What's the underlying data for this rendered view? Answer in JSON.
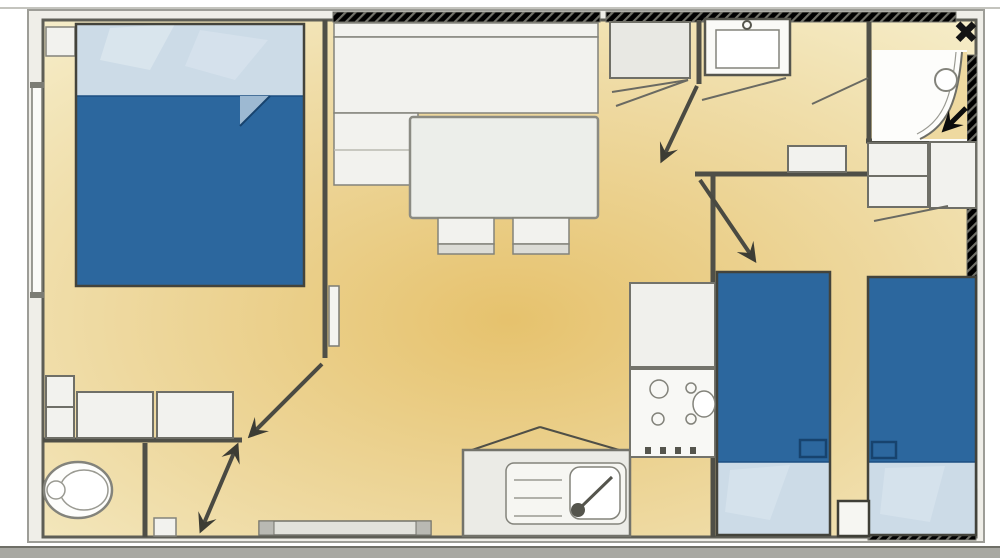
{
  "viewer": {
    "close_glyph": "✖"
  },
  "colors": {
    "background": "#ffffff",
    "bottom_bar": "#a8a8a2",
    "close_color": "#141414",
    "wall": "#4f4f47",
    "outer_wall_fill": "#efeee8",
    "outer_wall_stroke": "#9d9d97",
    "floor_light": "#f6eecb",
    "floor_mid": "#eed9a0",
    "floor_dark": "#e6c26d",
    "furniture_fill": "#f2f2ee",
    "furniture_stroke": "#83837b",
    "bed_blanket": "#2c679e",
    "bed_blanket_edge": "#1c4f82",
    "bed_pillow": "#ccdbe7"
  }
}
